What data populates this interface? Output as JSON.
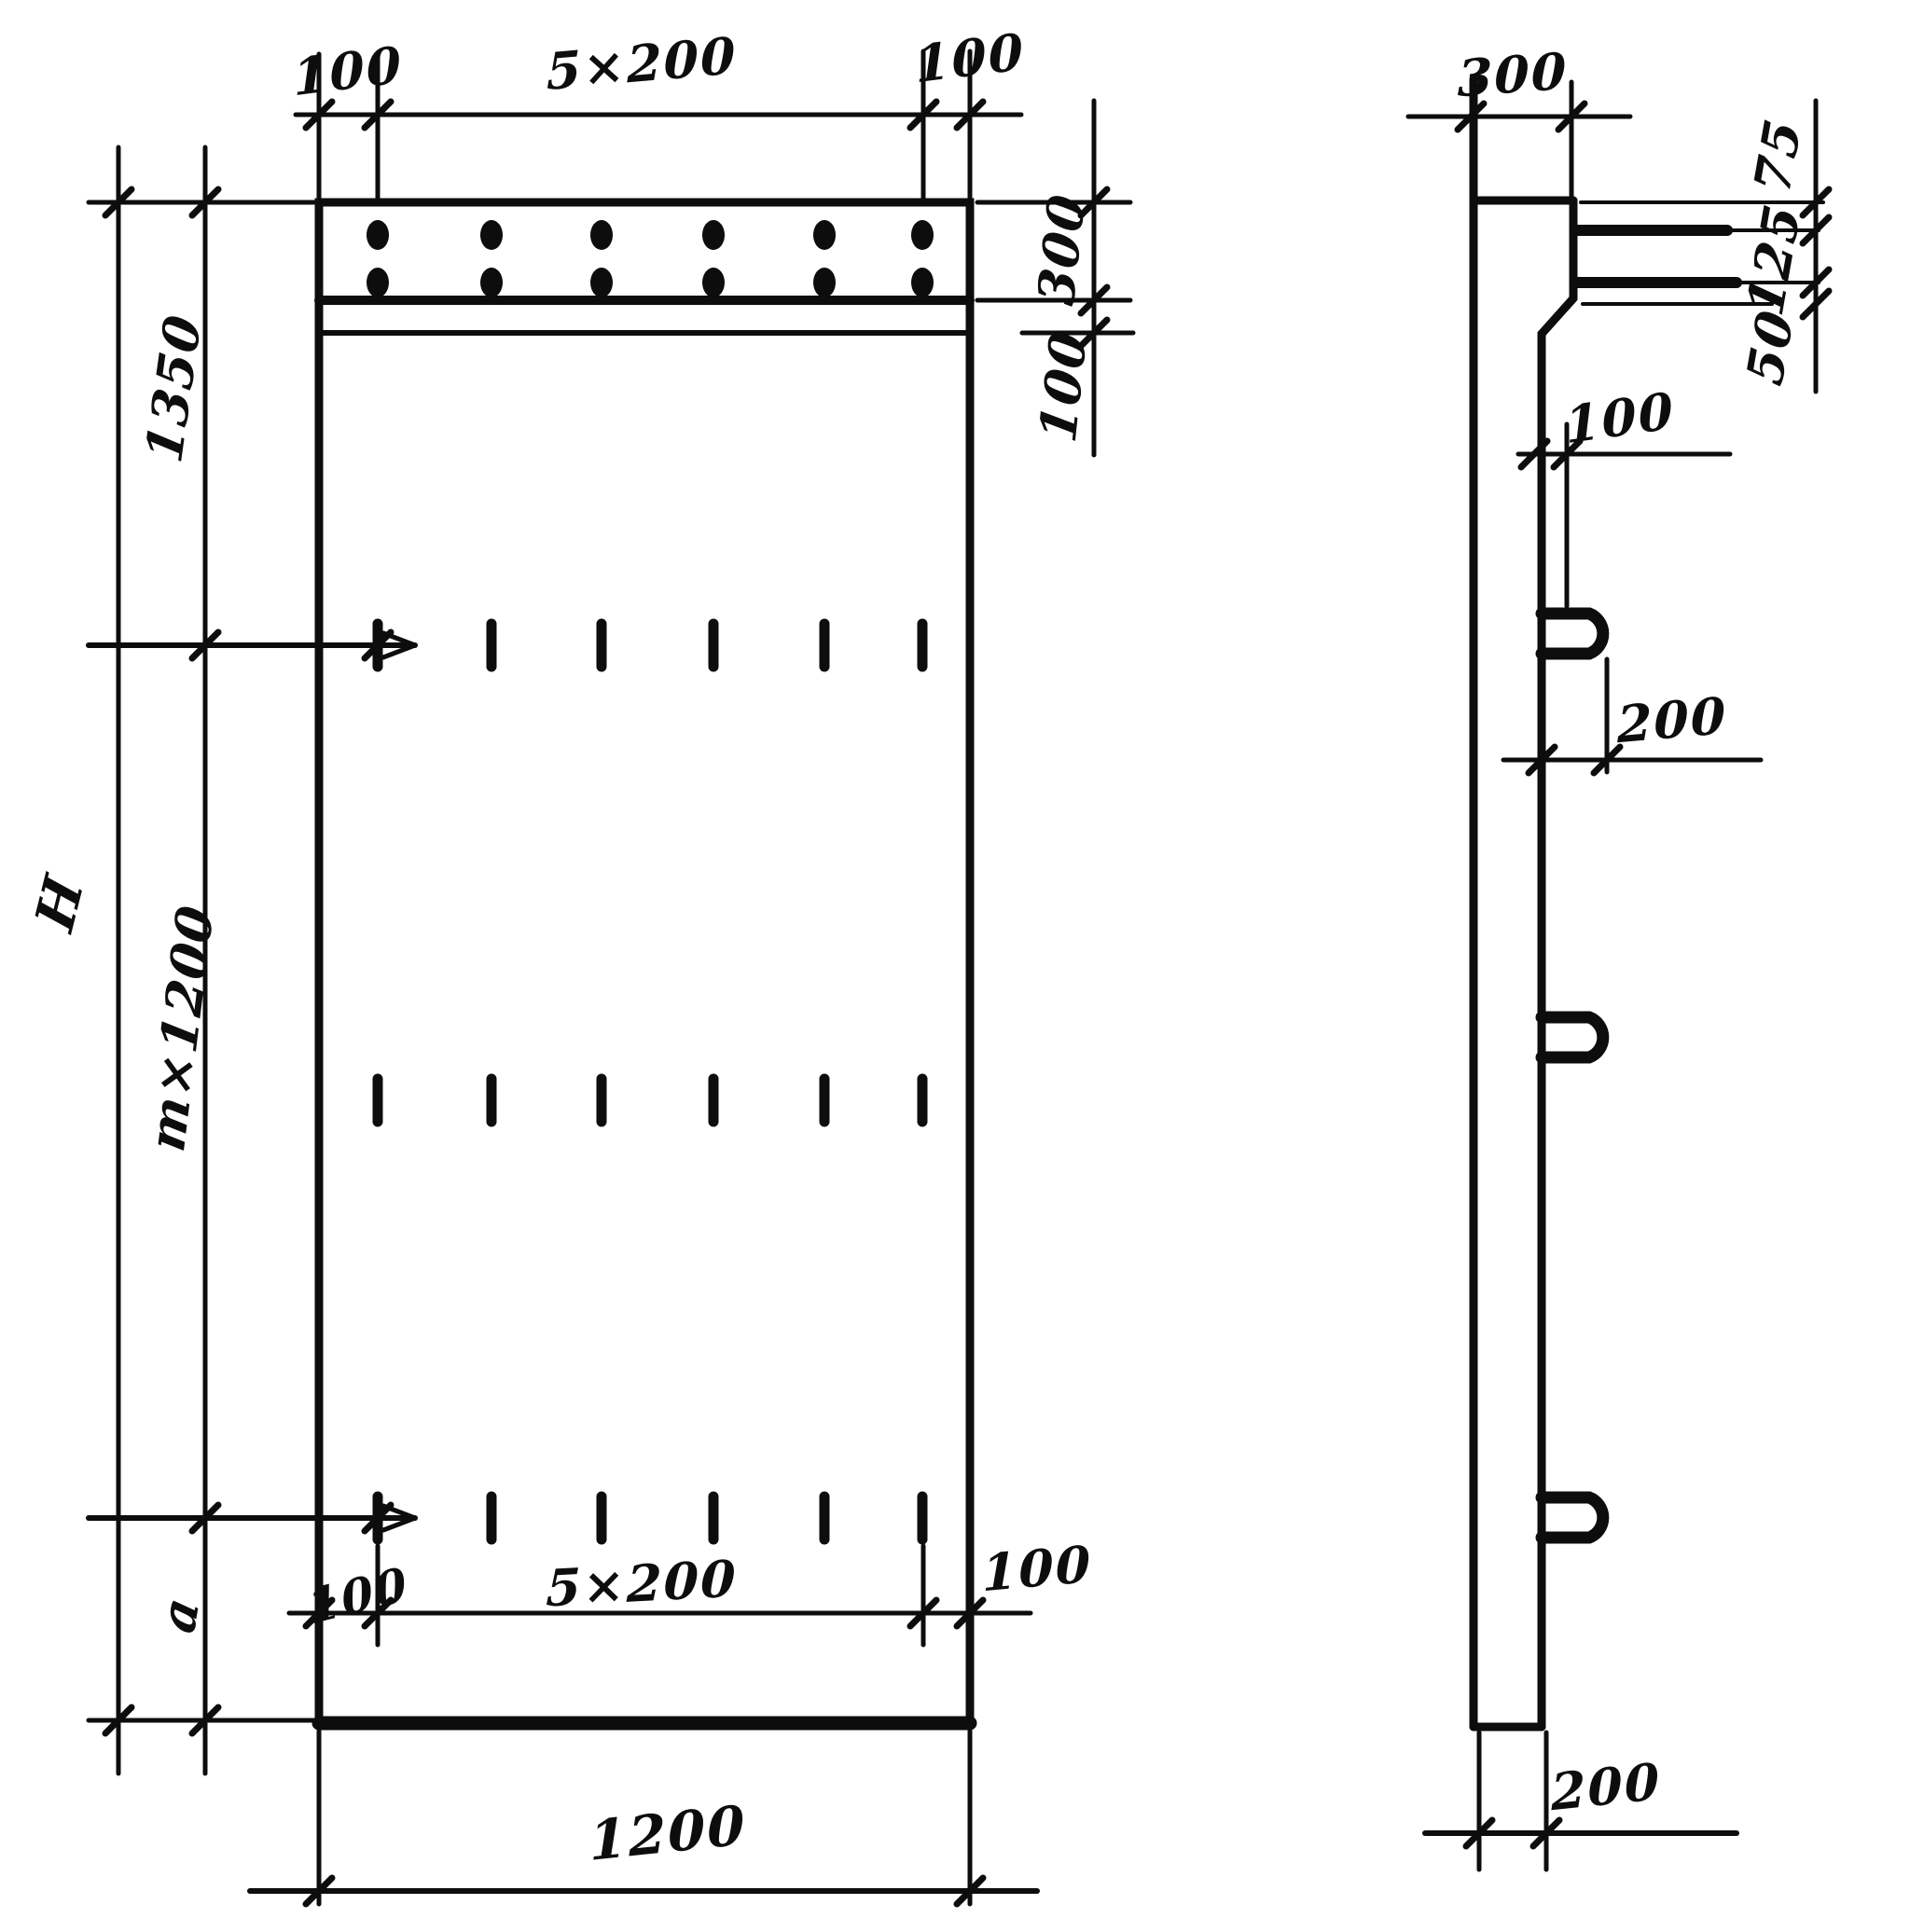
{
  "drawing_colors": {
    "ink": "#0d0d0d",
    "paper": "#ffffff"
  },
  "front": {
    "dims": {
      "top_left_margin": "100",
      "top_spacing": "5×200",
      "top_right_margin": "100",
      "band_height": "300",
      "strip_height": "100",
      "upper_segment": "1350",
      "overall_height": "H",
      "middle_segment": "m×1200",
      "lower_segment": "a",
      "bottom_left_margin": "100",
      "bottom_spacing": "5×200",
      "bottom_right_margin": "100",
      "overall_width": "1200"
    }
  },
  "side": {
    "dims": {
      "top_thickness": "300",
      "dowel_top_offset": "75",
      "dowel_spacing": "125",
      "dowel_bottom_offset": "50",
      "face_offset": "100",
      "loop_length": "200",
      "bottom_thickness": "200"
    }
  }
}
